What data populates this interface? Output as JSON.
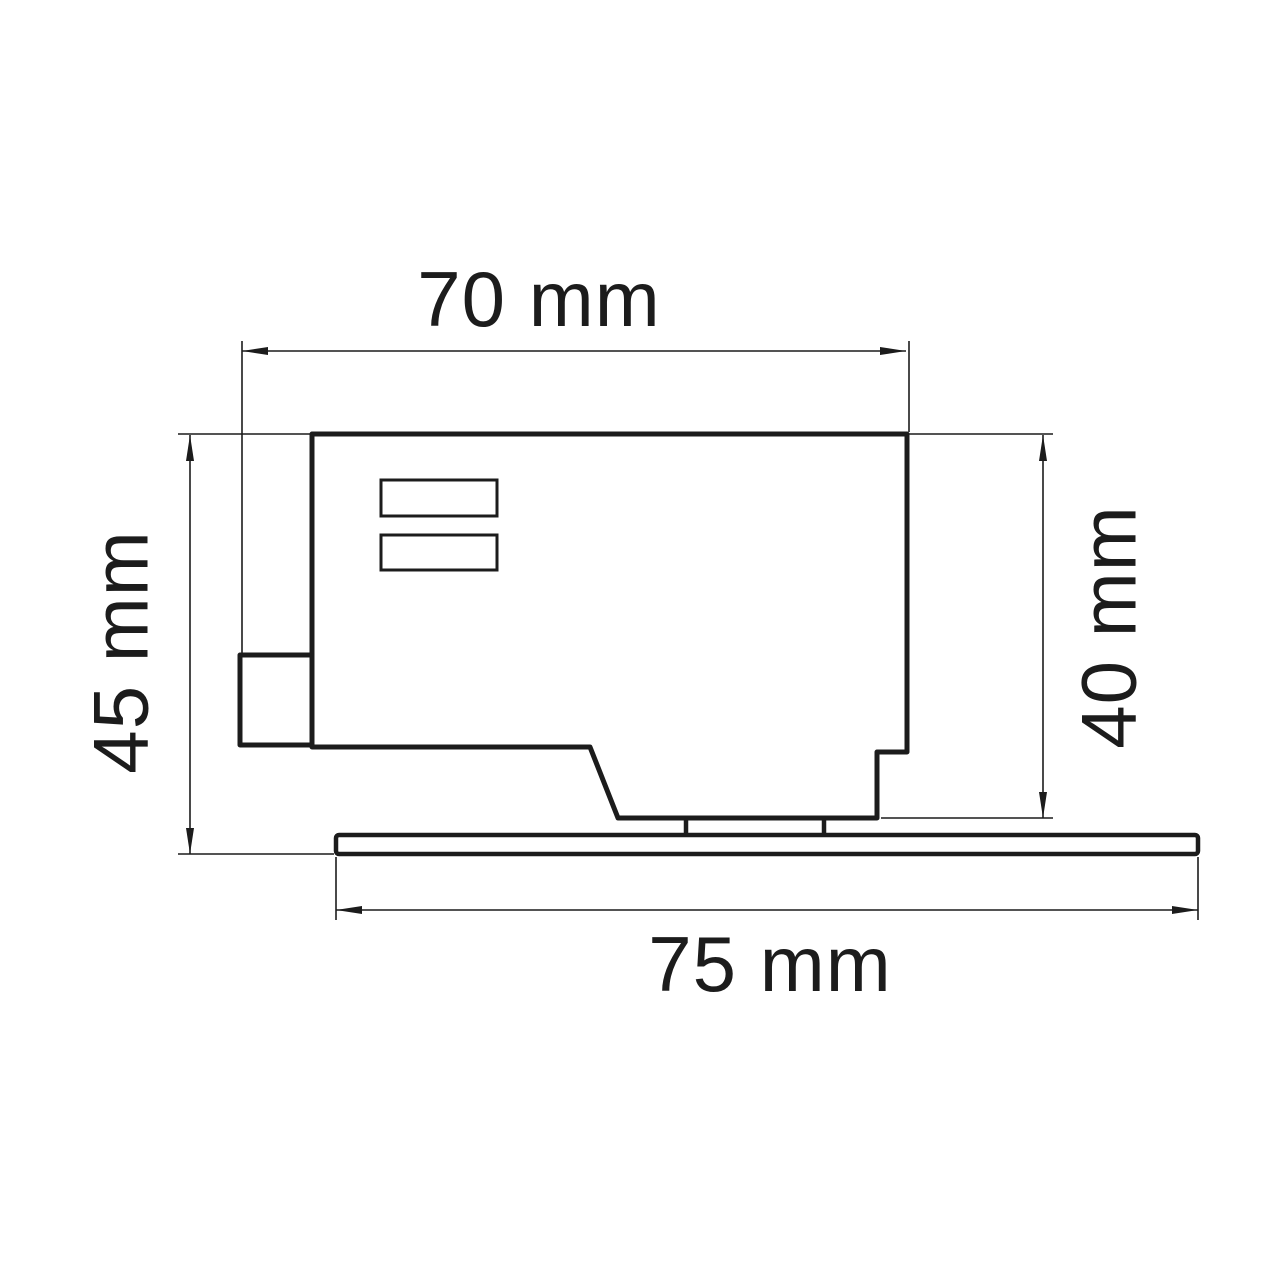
{
  "drawing": {
    "background": "#ffffff",
    "line_color": "#1c1c1c",
    "dimensions": {
      "width_top": {
        "label": "70 mm",
        "value": 70,
        "unit": "mm"
      },
      "height_left": {
        "label": "45 mm",
        "value": 45,
        "unit": "mm"
      },
      "height_right": {
        "label": "40 mm",
        "value": 40,
        "unit": "mm"
      },
      "width_bottom": {
        "label": "75 mm",
        "value": 75,
        "unit": "mm"
      }
    }
  }
}
